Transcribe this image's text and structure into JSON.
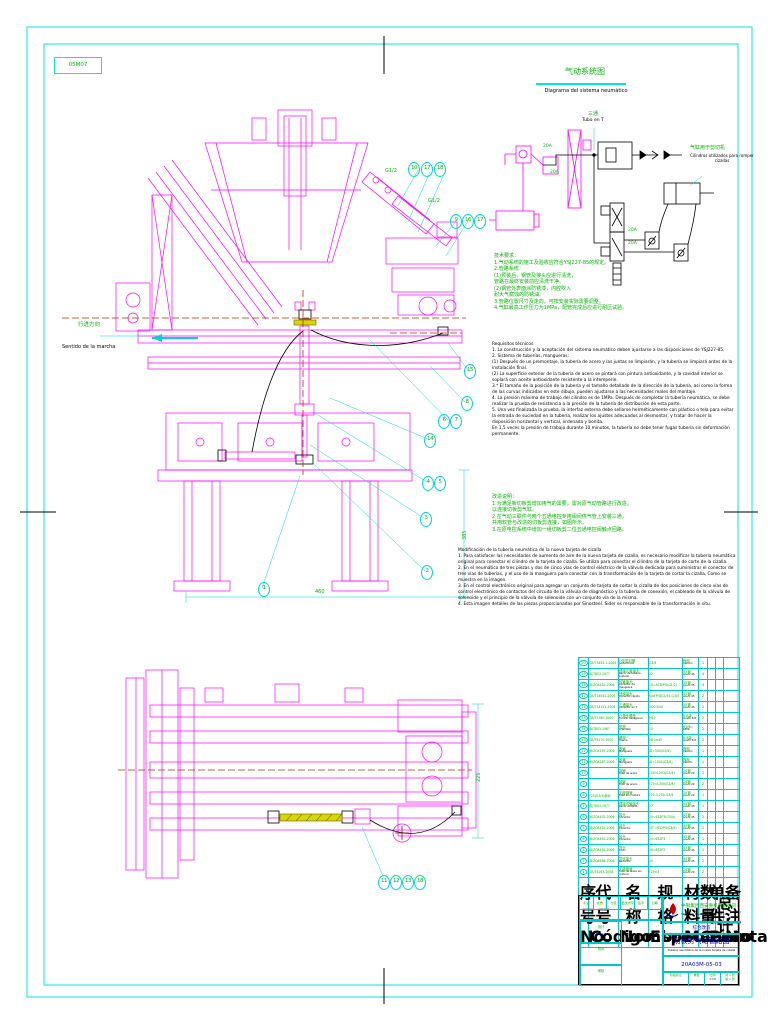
{
  "sheet": {
    "zone_code": "05M07",
    "direction_zh": "行进方向",
    "direction_es": "Sentido de la marcha",
    "dims": {
      "width_460": "460",
      "height_385": "385",
      "plan_225": "225",
      "port_upper": "G1/2",
      "port_lower": "G1/2"
    }
  },
  "pneumatic": {
    "title_zh": "气动系统图",
    "title_es": "Diagrama del sistema neumático",
    "tee_zh": "三通",
    "tee_es": "Tubo en T",
    "cyl_zh": "气缸用于剪切机",
    "cyl_es": "Cilindros utilizados para romper cizallas",
    "pipe_labels": [
      {
        "label": "20A",
        "x": 543,
        "y": 144
      },
      {
        "label": "20A",
        "x": 550,
        "y": 170
      },
      {
        "label": "20A",
        "x": 628,
        "y": 228
      },
      {
        "label": "20A",
        "x": 628,
        "y": 241
      }
    ]
  },
  "callouts": {
    "elevation": [
      {
        "label": "10",
        "x": 408,
        "y": 162
      },
      {
        "label": "17",
        "x": 421,
        "y": 162
      },
      {
        "label": "18",
        "x": 434,
        "y": 162
      },
      {
        "label": "9",
        "x": 450,
        "y": 214
      },
      {
        "label": "16",
        "x": 462,
        "y": 214
      },
      {
        "label": "17",
        "x": 474,
        "y": 214
      },
      {
        "label": "15",
        "x": 464,
        "y": 364
      },
      {
        "label": "8",
        "x": 461,
        "y": 396
      },
      {
        "label": "6",
        "x": 438,
        "y": 414
      },
      {
        "label": "7",
        "x": 450,
        "y": 414
      },
      {
        "label": "14",
        "x": 424,
        "y": 433
      },
      {
        "label": "4",
        "x": 422,
        "y": 476
      },
      {
        "label": "5",
        "x": 434,
        "y": 476
      },
      {
        "label": "3",
        "x": 420,
        "y": 512
      },
      {
        "label": "2",
        "x": 421,
        "y": 565
      },
      {
        "label": "1",
        "x": 258,
        "y": 582
      }
    ],
    "plan": [
      {
        "label": "11",
        "x": 378,
        "y": 875
      },
      {
        "label": "12",
        "x": 390,
        "y": 875
      },
      {
        "label": "13",
        "x": 402,
        "y": 875
      },
      {
        "label": "18",
        "x": 414,
        "y": 875
      }
    ]
  },
  "notes_requirements": {
    "zh_lines": [
      "技术要求：",
      "1.气动系统的施工及验收应符合YSJ227-85的规定。",
      "2.管路系统：",
      "(1)预装后，钢管及接头应进行清洗，",
      "管路在最终安装前应清洗干净。",
      "(2)钢管外表面涂防锈漆，内腔吹入",
      "耐大气腐蚀的防锈油。",
      "3.管路位置尺寸及走向，可按安装实际需要调整。",
      "4.气缸最高工作压力为1MPa，配管完成后应进行耐压试验。"
    ],
    "es_lines": [
      "Requisitos técnicos",
      "1. La construcción y la aceptación del sistema neumático deben ajustarse a las disposiciones de YSJ227-85.",
      "2. Sistema de tuberías, mangueras:",
      "(1) Después de un premontaje, la tubería de acero y las juntas se limpiarán, y la tubería se limpiará antes de la instalación final.",
      "(2) La superficie exterior de la tubería de acero se pintará con pintura antioxidante, y la cavidad interior se soplará con aceite antioxidante resistente a la intemperie.",
      "3.* El tamaño de la posición de la tubería y el tamaño detallado de la dirección de la tubería, así como la forma de las curvas indicadas en este dibujo, pueden ajustarse a las necesidades reales del montaje.",
      "4. La presión máxima de trabajo del cilindro es de 1MPa. Después de completar la tubería neumática, se debe realizar la prueba de resistencia a la presión de la tubería de distribución de esta parte.",
      "5. Una vez finalizada la prueba, la interfaz externa debe sellarse herméticamente con plástico o tela para evitar la entrada de suciedad en la tubería, realizar los ajustes adecuados al desmontar, y tratar de hacer la disposición horizontal y vertical, ordenada y bonita.",
      "En 1,5 veces la presión de trabajo durante 10 minutos, la tubería no debe tener fugas tubería sin deformación permanente."
    ]
  },
  "notes_modification": {
    "zh_lines": [
      "改造说明：",
      "1.为满足新切板剪增加用气的需要，需对原气动管路进行改造，",
      "以连接切板剪气缸。",
      "2.在气动三联件与两个五通电控专用阀间供气管上安装三通，",
      "并用软管与改造的切板剪连接，如图所示。",
      "3.在原电控系统中增加一组切板剪二位五通电控阀触点回路。"
    ],
    "es_lines": [
      "Modificación de la tubería neumática de la nueva tarjeta de cizalla",
      "1. Para satisfacer las necesidades de aumento de aire de la nueva tarjeta de cizalla, es necesario modificar la tubería neumática original para conectar el cilindro de la tarjeta de cizalla. Se utiliza para conectar el cilindro de la tarjeta de corte de la cizalla.",
      "2. En el neumático de tres piezas y dos de cinco vías de control eléctrico de la válvula dedicada para suministrar el conector de tres vías de tuberías, y el uso de la manguera para conectar con la transformación de la tarjeta de cortar la cizalla. Como se muestra en la imagen.",
      "3. En el control electrónico original para agregar un conjunto de tarjeta de cortar la cizalla de dos posiciones de cinco vías de control electrónico de contactos del circuito de la válvula de diagnóstico y la tubería de conexión, el cableado de la válvula de solenoide y el principio de la válvula de solenoide con un conjunto vía de la misma.",
      "4. Esta imagen detalles de las piezas proporcionadas por Sinosteel. Sider es responsable de la transformación in situ."
    ]
  },
  "bom": {
    "headers": [
      {
        "zh": "序号",
        "es": "No."
      },
      {
        "zh": "代号",
        "es": "Código"
      },
      {
        "zh": "名称",
        "es": "Nombre"
      },
      {
        "zh": "规格",
        "es": "Espec."
      },
      {
        "zh": "材料",
        "es": "Mat."
      },
      {
        "zh": "数量",
        "es": "Cant."
      },
      {
        "zh": "单件",
        "es": "Peso"
      },
      {
        "zh": "总计",
        "es": ""
      },
      {
        "zh": "备注",
        "es": "Nota"
      }
    ],
    "rows": [
      {
        "no": "20",
        "code": "GB/T3452.1-2005",
        "name_zh": "O形密封圈",
        "name_es": "Junta tórica",
        "spec": "G3/4",
        "mat_zh": "橡胶",
        "mat_es": "Caucho",
        "qty": "1"
      },
      {
        "no": "19",
        "code": "JB/T853-1977",
        "name_zh": "焊接式管接头",
        "name_es": "Racor de tubería soldado",
        "spec": "22",
        "mat_zh": "45钢",
        "mat_es": "Acero 45",
        "qty": "4"
      },
      {
        "no": "18",
        "code": "JB/ZQ4432-2006",
        "name_zh": "软管接头",
        "name_es": "Conector de manguera",
        "spec": "10=ACB/PG(G1/2)",
        "mat_zh": "35钢",
        "mat_es": "Acero 35",
        "qty": "4"
      },
      {
        "no": "17",
        "code": "GB/T14042-2006",
        "name_zh": "快换接头",
        "name_es": "Conector rápido",
        "spec": "KJ4FP/DG2/44-G3/4",
        "mat_zh": "45钢",
        "mat_es": "Acero 45",
        "qty": "2"
      },
      {
        "no": "16",
        "code": "GB/T14111-2006",
        "name_zh": "三通接头",
        "name_es": "Conector en T",
        "spec": "VDG3/44",
        "mat_zh": "45钢",
        "mat_es": "Acero 45",
        "qty": "2"
      },
      {
        "no": "15",
        "code": "GB/T5780-2000",
        "name_zh": "六角头螺栓",
        "name_es": "Tornillo hexagonal",
        "spec": "M10",
        "mat_zh": "8.8级",
        "mat_es": "Grado 8.8",
        "qty": "2"
      },
      {
        "no": "14",
        "code": "JB/T853-1987",
        "name_zh": "垫圈",
        "name_es": "Arandela",
        "spec": "10",
        "mat_zh": "65Mn",
        "mat_es": "65Mn",
        "qty": "2"
      },
      {
        "no": "13",
        "code": "GB/T6170-2000",
        "name_zh": "螺母",
        "name_es": "Tuerca",
        "spec": "M10×45",
        "mat_zh": "8.8级",
        "mat_es": "Grado 8.8",
        "qty": "2"
      },
      {
        "no": "12",
        "code": "JB/ZQ4187-2006",
        "name_zh": "胶管",
        "name_es": "Manguera",
        "spec": "ID=500(G3/4)",
        "mat_zh": "橡胶",
        "mat_es": "Caucho",
        "qty": "1"
      },
      {
        "no": "11",
        "code": "JB/ZQ4187-2006",
        "name_zh": "胶管",
        "name_es": "Manguera",
        "spec": "ID=1000(G3/4)",
        "mat_zh": "橡胶",
        "mat_es": "Caucho",
        "qty": "1"
      },
      {
        "no": "10",
        "code": "",
        "name_zh": "钢管",
        "name_es": "Tubo de acero",
        "spec": "L04=L203(G3/4)",
        "mat_zh": "20钢",
        "mat_es": "Acero 20",
        "qty": "2"
      },
      {
        "no": "9",
        "code": "",
        "name_zh": "钢管",
        "name_es": "Tubo de acero",
        "spec": "F25=L300(G3/4)",
        "mat_zh": "20钢",
        "mat_es": "Acero 20",
        "qty": "2"
      },
      {
        "no": "8",
        "code": "F25(G3/4)钢管",
        "name_zh": "无缝钢管",
        "name_es": "Tubo sin costura",
        "spec": "F25-3.25A-G3/4",
        "mat_zh": "20钢",
        "mat_es": "Acero 20",
        "qty": "1"
      },
      {
        "no": "7",
        "code": "JB/T853-1977",
        "name_zh": "焊接式管接头",
        "name_es": "Racor soldado",
        "spec": "27",
        "mat_zh": "45钢",
        "mat_es": "Acero 45",
        "qty": "1"
      },
      {
        "no": "6",
        "code": "JB/ZQ4432-2006",
        "name_zh": "接头",
        "name_es": "Conector",
        "spec": "20=632P3(G3/4)",
        "mat_zh": "45钢",
        "mat_es": "Acero 45",
        "qty": "1"
      },
      {
        "no": "5",
        "code": "JB/ZQ4432-2006",
        "name_zh": "接头",
        "name_es": "Conector",
        "spec": "45°=632P3(G3/4)",
        "mat_zh": "45钢",
        "mat_es": "Acero 45",
        "qty": "1"
      },
      {
        "no": "4",
        "code": "JB/ZQ4432-2006",
        "name_zh": "接头",
        "name_es": "Conector",
        "spec": "20=632P3",
        "mat_zh": "45钢",
        "mat_es": "Acero 45",
        "qty": "1"
      },
      {
        "no": "3",
        "code": "JB/ZQ4432-2006",
        "name_zh": "弯头",
        "name_es": "Codo",
        "spec": "20=632P2",
        "mat_zh": "45钢",
        "mat_es": "Acero 45",
        "qty": "1"
      },
      {
        "no": "2",
        "code": "JB/ZQ4636-2006",
        "name_zh": "异径接头",
        "name_es": "Reductor",
        "spec": "20",
        "mat_zh": "45钢",
        "mat_es": "Acero 45",
        "qty": "2"
      },
      {
        "no": "1",
        "code": "GB/T8163-2008",
        "name_zh": "无缝钢管",
        "name_es": "Tubo de acero sin costura",
        "spec": "F25×3",
        "mat_zh": "20钢",
        "mat_es": "Acero 20",
        "qty": "2"
      }
    ]
  },
  "title_block": {
    "company_zh": "中钢集团西安重机有限公司",
    "company_en": "Sinosteel Xi'an Machinery CO., LTD",
    "project": "综合改造",
    "title_zh": "切板剪气动管路图",
    "title_es": "Tubería neumática de la nueva tarjeta de cizalla",
    "drawing_no": "20A03M-05-03",
    "rev_headers": [
      "标记",
      "处数",
      "分区",
      "更改文件号",
      "签字",
      "日期"
    ],
    "roles": [
      {
        "label": "设计",
        "date": "2009.5"
      },
      {
        "label": "校对",
        "date": ""
      },
      {
        "label": "审核",
        "date": ""
      },
      {
        "label": "工艺",
        "date": ""
      },
      {
        "label": "标准化",
        "date": ""
      },
      {
        "label": "批准",
        "date": ""
      }
    ],
    "stage_label": "阶段标记",
    "weight_label": "重量",
    "scale_label": "比例",
    "scale_value": "1:10",
    "sheet_count": "共 1 张",
    "sheet_no": "第 1 张"
  }
}
